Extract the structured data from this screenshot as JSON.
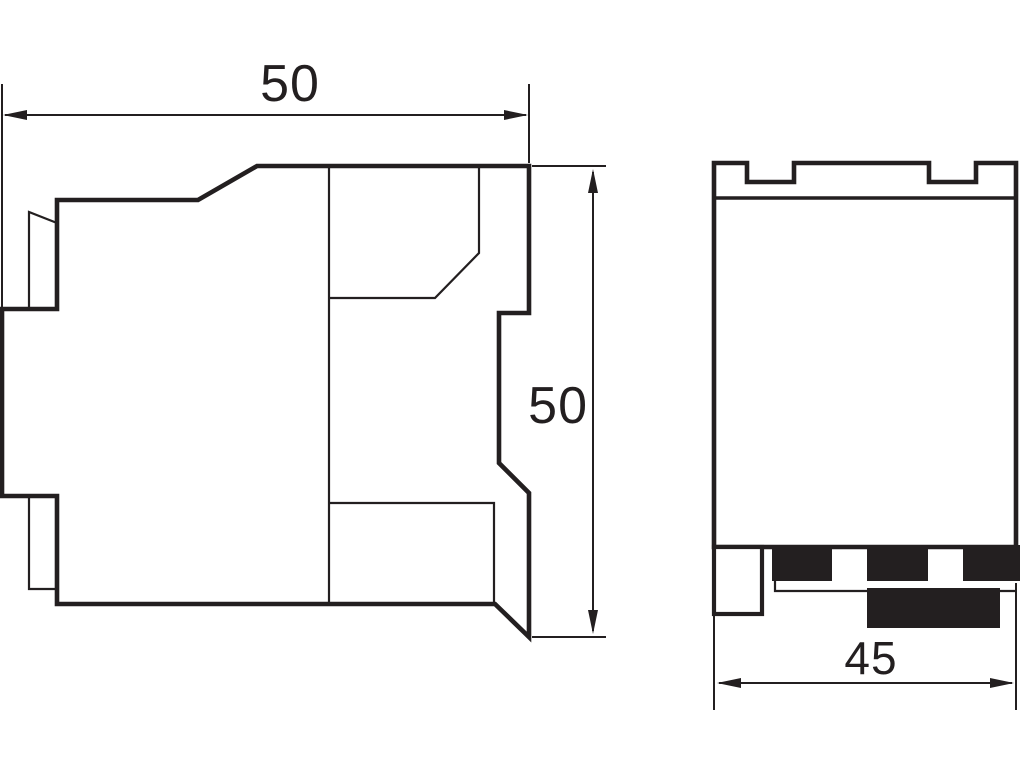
{
  "colors": {
    "ink": "#231f20",
    "paper": "#ffffff"
  },
  "dimensions": {
    "side_width_label": "50",
    "side_height_label": "50",
    "front_width_label": "45"
  }
}
